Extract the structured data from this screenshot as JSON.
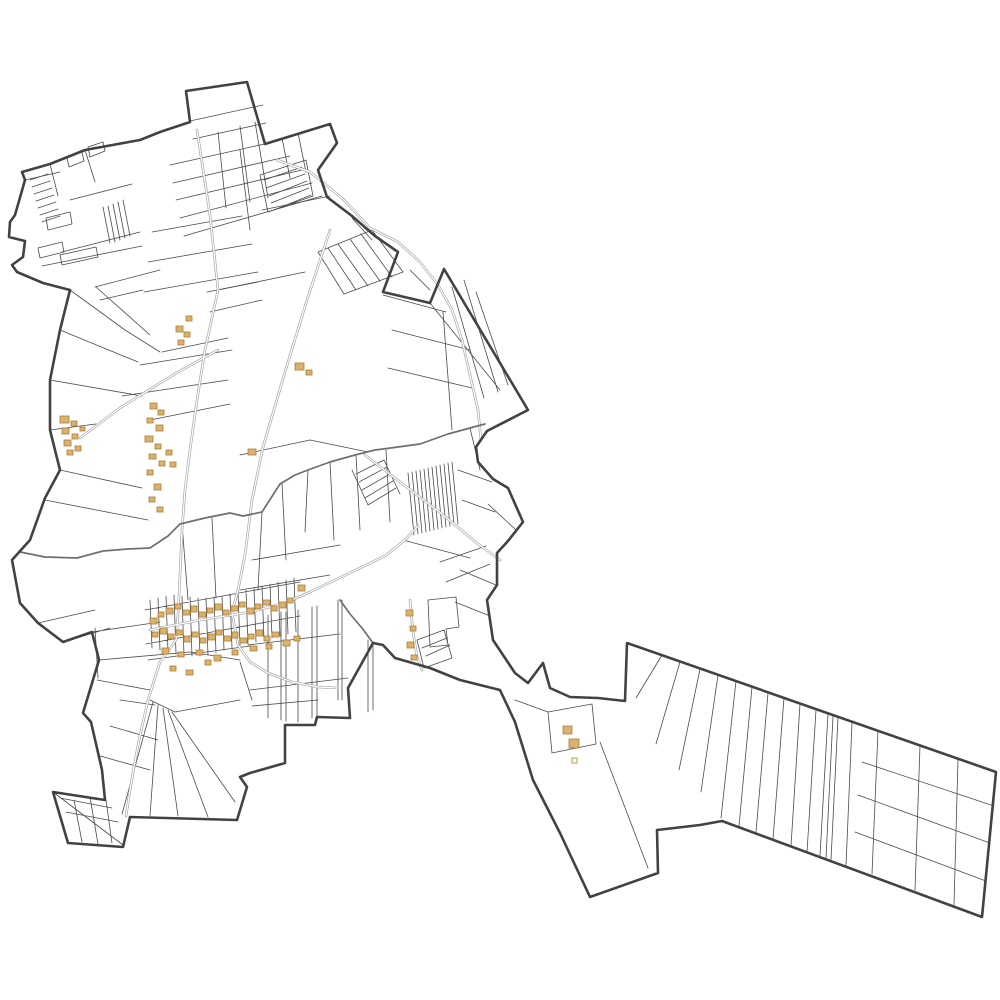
{
  "page": {
    "background": "#ffffff"
  },
  "styles": {
    "boundary": {
      "color": "#424242",
      "width": 2.6
    },
    "parcel": {
      "color": "#4a4a4a",
      "width": 0.8
    },
    "road": {
      "casing": "#a6a6a6",
      "inner": "#ffffff"
    },
    "stream": {
      "color": "#6f6f6f",
      "width": 1.7
    },
    "building": {
      "fill": "#d9b272",
      "stroke": "#ad7d33"
    }
  },
  "map": {
    "boundary_path": "M186,91 L247,82 L265,144 L330,124 L337,143 L318,170 L327,197 L352,216 L375,236 L398,252 L383,292 L430,303 L444,269 L528,410 L487,431 L476,447 L478,462 L493,479 L508,488 L523,522 L508,541 L497,553 L497,585 L487,600 L493,640 L515,673 L528,683 L543,663 L550,688 L570,697 L598,698 L625,701 L627,643 L996,772 L982,917 L722,821 L700,825 L657,830 L658,873 L590,897 L560,833 L533,780 L515,722 L500,690 L460,680 L430,668 L395,658 L383,645 L373,643 L348,688 L350,718 L317,717 L315,725 L285,725 L285,763 L250,773 L240,777 L247,787 L237,820 L130,817 L123,847 L68,843 L53,792 L105,800 L102,770 L91,722 L83,713 L99,660 L92,632 L63,642 L38,623 L20,603 L12,560 L30,540 L45,498 L60,470 L50,430 L50,380 L60,330 L70,290 L43,283 L17,272 L12,265 L23,257 L25,241 L9,237 L10,222 L15,215 L25,180 L22,172 L50,164 L85,150 L140,140 L160,132 L190,122 Z",
    "parcel_paths": [
      "M190,121 L263,105 M193,139 L266,123 M170,165 L278,141 M173,183 L290,156 M176,200 L302,170 M180,218 L312,183 M184,236 L322,196",
      "M218,132 L226,208 M240,126 L250,202 M255,122 L268,198 M282,138 L290,178 M298,133 L306,172 M207,292 L258,282 M210,312 L262,300",
      "M70,200 L132,184 M62,252 L140,232 M42,266 L142,246 M95,287 L160,270 M25,180 L60,172 M50,164 L58,196 M85,150 L95,182",
      "M38,248 L62,242 L64,252 L40,258 Z M60,255 L96,247 L98,257 L62,265 Z M67,158 L82,152 L84,161 L69,167 Z M88,147 L103,142 L105,151 L90,157 Z M46,218 L70,212 L72,224 L48,230 Z",
      "M30,180 L48,174 M32,187 L50,181 M34,194 L52,188 M36,201 L54,195 M38,208 L56,202 M40,215 L58,209 M42,222 L60,216",
      "M103,207 L110,243 M108,206 L115,242 M113,204 L120,240 M118,202 L125,238 M123,200 L130,236",
      "M70,290 L125,330 M60,330 L138,362 M50,380 L142,396 M50,430 L96,424 M96,287 L150,335 M125,330 L160,352 M140,365 L232,350 M122,396 L228,380 M100,300 L143,290",
      "M152,232 L242,216 M148,262 L252,244 M144,292 L258,272 M240,150 L250,230 M262,210 L330,196 M218,290 L305,272 M162,352 L228,338 M150,420 L230,404",
      "M260,175 L306,160 L313,196 L268,212 Z M264,180 L302,167 M266,188 L305,174 M269,196 L307,181 M271,203 L309,188 M274,210 L311,195",
      "M318,252 L344,294 M328,248 L356,290 M338,244 L368,286 M350,239 L380,281 M361,234 L392,277 M372,230 L403,272 M318,252 L372,230 M344,294 L403,272",
      "M444,269 L430,303 M452,287 L484,398 M464,280 L498,392 M476,292 L508,385 M430,303 L500,390 M383,295 L446,312 M392,330 L470,350 M388,368 L472,388 M443,312 L452,430 M398,252 L383,292 M352,218 L372,240 M410,270 L430,290",
      "M408,473 L414,535 M412,472 L418,534 M416,471 L422,533 M420,470 L426,532 M424,469 L430,531 M428,468 L434,530 M432,467 L438,529 M436,466 L442,528 M440,465 L446,527 M444,464 L450,526 M448,463 L454,525 M452,462 L458,524",
      "M356,474 L384,460 M359,482 L387,467 M362,490 L390,474 M365,498 L393,481 M368,505 L396,488 M352,470 L368,505 M384,460 L400,494",
      "M403,540 L470,558 M440,562 L486,546 M446,582 L490,564 M458,470 L492,482 M462,500 L495,512 M488,504 L516,530 M470,428 L480,470",
      "M240,455 L310,440 L368,452 M262,512 L258,590 M282,484 L286,560 M308,470 L305,532 M330,462 L334,540 M356,455 L360,530 M386,450 L390,522 M212,518 L216,598 M182,524 L188,600 M252,560 L340,545 M240,590 L330,575",
      "M150,600 L152,648 M158,598 L160,650 M166,596 L168,652 M174,595 L176,654 M182,596 L184,655 M190,597 L192,656 M198,598 L200,656 M206,598 L208,655 M214,597 L216,653 M222,596 L224,650 M230,594 L232,648 M238,592 L240,646 M246,590 L248,644 M254,588 L256,642 M262,586 L264,640 M270,584 L272,638 M278,582 L280,636 M286,580 L288,634 M294,578 L296,632 M145,610 L300,582 M146,644 L300,616 M148,660 L250,646",
      "M268,615 L268,718 M281,612 L281,720 M286,612 L286,721 M298,610 L298,722 M312,607 L312,718 M317,606 L317,717 M338,600 L338,700 M342,600 L342,700 M368,640 L368,712 M373,645 L373,710 M248,645 L340,634 M250,690 L348,678 M252,706 L318,700 M240,662 L252,700",
      "M417,640 L444,630 L452,658 L424,668 Z M422,648 L447,638 M426,656 L450,645",
      "M428,600 L456,597 L459,627 L446,629 L448,645 L430,647 Z M460,570 L496,585 M455,602 L490,616",
      "M153,702 L122,814 M158,705 L150,816 M163,708 L178,816 M168,710 L208,817 M172,712 L235,802 M150,700 L175,712 M100,756 L150,770 M110,726 L158,740 M120,700 L155,705 M97,680 L150,690 M99,660 L190,652 M190,652 L240,660 M175,712 L240,700",
      "M60,798 L112,808 M66,812 L118,822 M74,800 L82,842 M90,797 L98,844 M106,800 L112,843 M53,792 L123,845",
      "M45,500 L148,520 M60,470 L142,488 M38,623 L95,610 M63,642 L110,628 M95,628 L98,678 M92,632 L160,622",
      "M600,742 L648,868 M548,712 L592,704 L596,744 L552,753 Z M515,700 L548,712",
      "M662,655 L636,698 M680,662 L656,744 M700,669 L679,770 M718,675 L701,792 M736,681 L721,818 M752,687 L739,826 M768,693 L756,832 M784,698 L773,839 M800,704 L791,846 M816,710 L807,852 M828,714 L820,856 M833,716 L826,858 M838,718 L831,860 M852,723 L846,866",
      "M878,731 L872,874 M920,746 L915,890 M958,759 L954,905 M862,762 L994,806 M858,795 L990,843 M855,832 L986,881"
    ],
    "road_paths": [
      "M197,130 L210,215 L218,290 L205,350 L197,400 L190,450 L185,490 L182,530 L180,575 L178,615 L176,640",
      "M150,630 L200,620 L250,612 L285,603 L310,592 L335,580 L360,568 L385,556 L405,540 L418,526",
      "M330,230 L307,300 L285,372 L263,447 L252,500 L245,555 L238,590 L232,612",
      "M277,160 L310,172 L342,198 L370,228 L398,242 L420,262 L438,285 L452,310 L462,340 L470,375 L478,410 L481,440",
      "M80,438 L120,408 L152,388 L178,372 L200,360 L218,350",
      "M232,612 L238,645 L250,662 L268,673 L292,682 L318,687 L338,688",
      "M176,640 L160,662 L148,700 L138,745 L130,790 L126,816",
      "M410,600 L413,632 L417,657 L422,670",
      "M365,455 L400,482 L442,514 L478,544 L500,560"
    ],
    "stream_paths": [
      "M20,552 L45,557 L77,558 L103,551 L128,549 L150,548 L168,536 L180,524 L205,518 L230,513 L243,516 L262,512 L280,484 L295,475 L308,470 L330,462 L355,455 L375,450 L398,447 L420,444 L448,434 L470,428 L485,424",
      "M340,600 L350,614 L362,628 L373,643"
    ],
    "buildings": [
      [
        150,
        618,
        7,
        6
      ],
      [
        158,
        612,
        6,
        5
      ],
      [
        166,
        608,
        7,
        6
      ],
      [
        175,
        604,
        6,
        5
      ],
      [
        183,
        610,
        7,
        5
      ],
      [
        191,
        606,
        6,
        6
      ],
      [
        199,
        612,
        7,
        5
      ],
      [
        207,
        608,
        6,
        5
      ],
      [
        215,
        604,
        7,
        6
      ],
      [
        223,
        610,
        6,
        5
      ],
      [
        231,
        606,
        7,
        5
      ],
      [
        239,
        602,
        6,
        5
      ],
      [
        247,
        608,
        7,
        6
      ],
      [
        255,
        604,
        6,
        5
      ],
      [
        263,
        600,
        7,
        5
      ],
      [
        271,
        606,
        6,
        5
      ],
      [
        279,
        602,
        7,
        6
      ],
      [
        287,
        598,
        6,
        5
      ],
      [
        152,
        632,
        6,
        5
      ],
      [
        160,
        628,
        7,
        6
      ],
      [
        168,
        634,
        6,
        5
      ],
      [
        176,
        630,
        7,
        5
      ],
      [
        184,
        636,
        6,
        6
      ],
      [
        192,
        632,
        7,
        5
      ],
      [
        200,
        638,
        6,
        5
      ],
      [
        208,
        634,
        7,
        6
      ],
      [
        216,
        630,
        6,
        5
      ],
      [
        224,
        636,
        7,
        5
      ],
      [
        232,
        632,
        6,
        6
      ],
      [
        240,
        638,
        7,
        5
      ],
      [
        248,
        634,
        6,
        5
      ],
      [
        256,
        630,
        7,
        6
      ],
      [
        264,
        636,
        6,
        5
      ],
      [
        272,
        632,
        7,
        5
      ],
      [
        162,
        648,
        7,
        6
      ],
      [
        178,
        652,
        6,
        5
      ],
      [
        196,
        650,
        7,
        5
      ],
      [
        205,
        660,
        6,
        5
      ],
      [
        214,
        655,
        7,
        6
      ],
      [
        170,
        666,
        6,
        5
      ],
      [
        186,
        670,
        7,
        5
      ],
      [
        232,
        650,
        6,
        5
      ],
      [
        250,
        646,
        7,
        5
      ],
      [
        266,
        644,
        6,
        5
      ],
      [
        283,
        640,
        7,
        6
      ],
      [
        294,
        636,
        6,
        5
      ],
      [
        298,
        585,
        7,
        6
      ],
      [
        406,
        610,
        7,
        6
      ],
      [
        410,
        626,
        6,
        5
      ],
      [
        407,
        642,
        7,
        6
      ],
      [
        411,
        655,
        6,
        5
      ],
      [
        150,
        403,
        7,
        6
      ],
      [
        158,
        410,
        6,
        5
      ],
      [
        147,
        418,
        6,
        5
      ],
      [
        156,
        425,
        7,
        6
      ],
      [
        145,
        436,
        8,
        6
      ],
      [
        155,
        444,
        6,
        5
      ],
      [
        149,
        454,
        7,
        5
      ],
      [
        159,
        461,
        6,
        5
      ],
      [
        147,
        470,
        6,
        5
      ],
      [
        154,
        484,
        7,
        6
      ],
      [
        149,
        497,
        6,
        5
      ],
      [
        157,
        507,
        6,
        5
      ],
      [
        166,
        450,
        6,
        5
      ],
      [
        170,
        462,
        6,
        5
      ],
      [
        176,
        326,
        7,
        6
      ],
      [
        184,
        332,
        6,
        5
      ],
      [
        178,
        340,
        6,
        5
      ],
      [
        186,
        316,
        6,
        5
      ],
      [
        295,
        363,
        9,
        7
      ],
      [
        306,
        370,
        6,
        5
      ],
      [
        248,
        449,
        8,
        6
      ],
      [
        60,
        416,
        9,
        7
      ],
      [
        71,
        421,
        6,
        5
      ],
      [
        62,
        428,
        7,
        6
      ],
      [
        72,
        434,
        6,
        5
      ],
      [
        64,
        440,
        7,
        6
      ],
      [
        75,
        446,
        6,
        5
      ],
      [
        67,
        450,
        6,
        5
      ],
      [
        80,
        427,
        5,
        4
      ],
      [
        563,
        726,
        9,
        8
      ],
      [
        569,
        739,
        10,
        9
      ]
    ],
    "building_outlines": [
      [
        572,
        758,
        5,
        5
      ]
    ]
  }
}
